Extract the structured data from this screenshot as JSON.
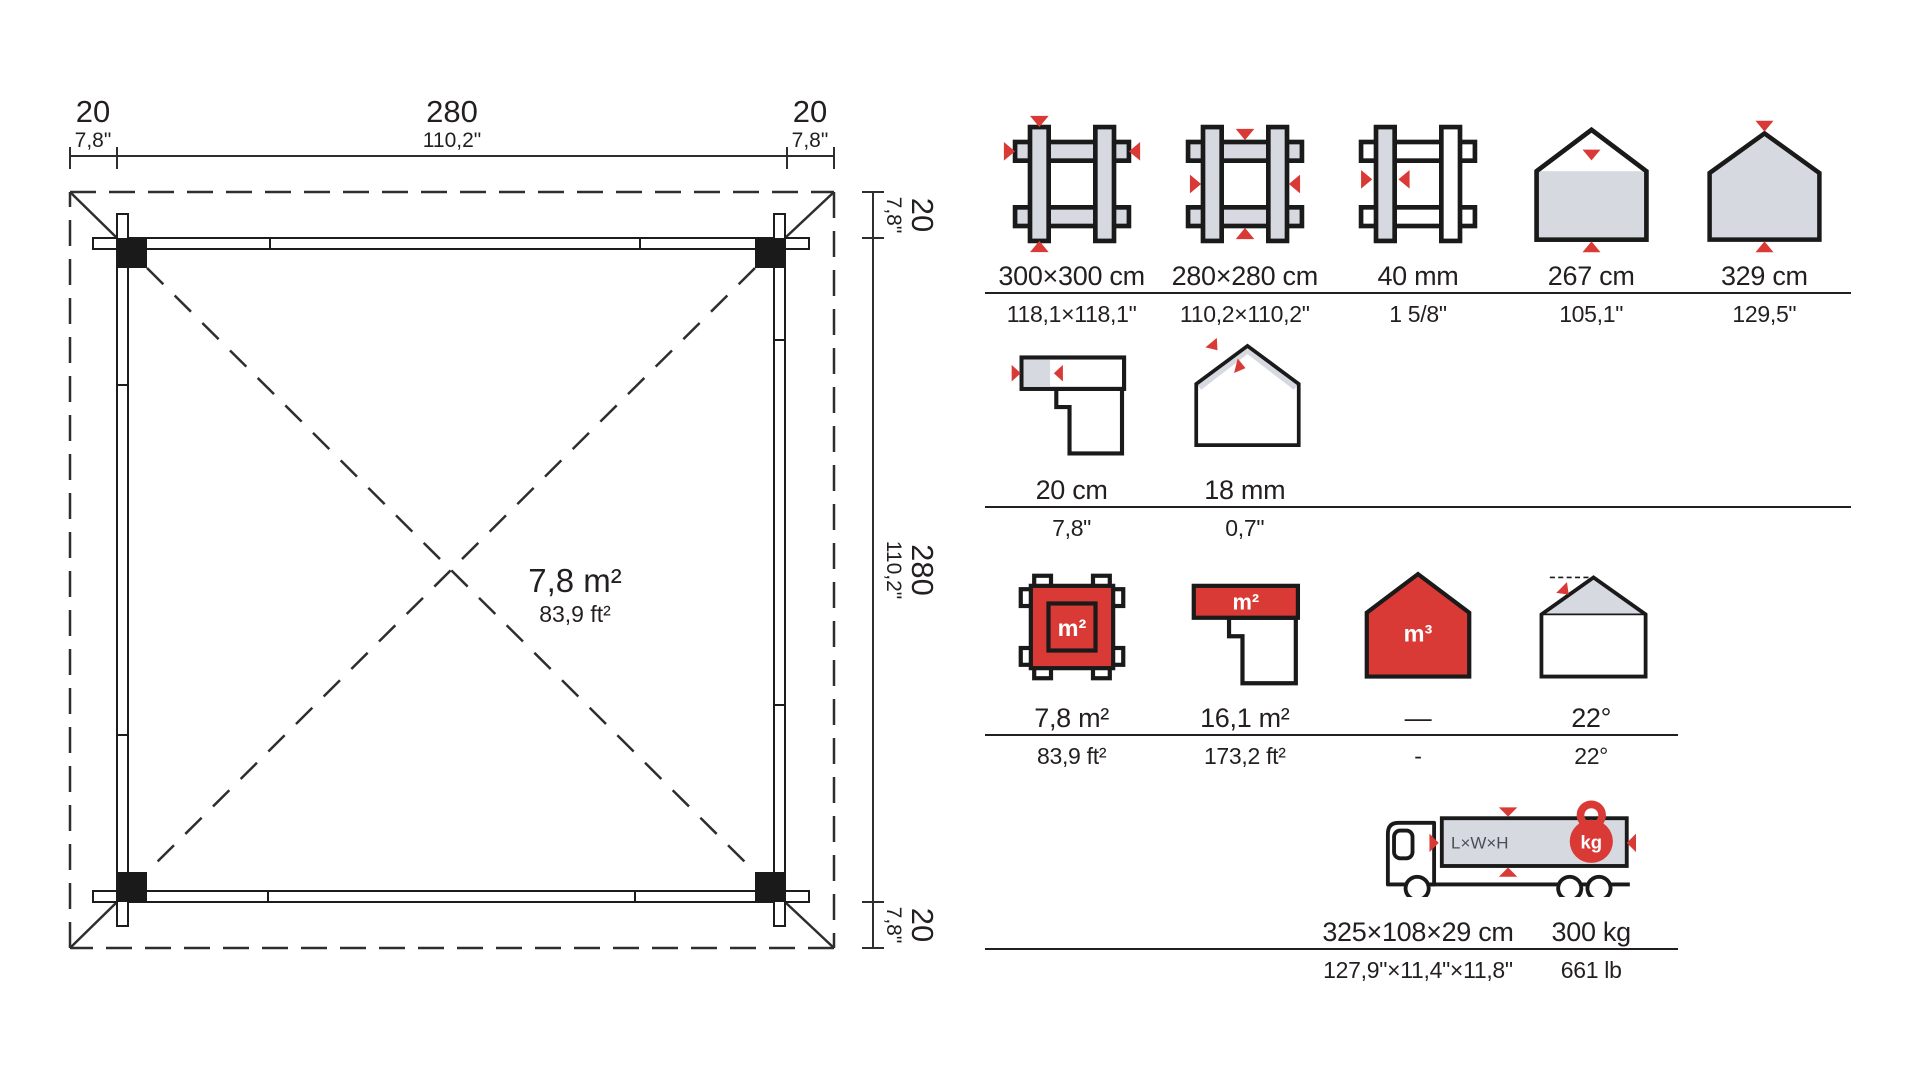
{
  "plan": {
    "area": {
      "metric": "7,8 m²",
      "imperial": "83,9 ft²"
    },
    "dim_top": {
      "left_cm": "20",
      "left_in": "7,8\"",
      "mid_cm": "280",
      "mid_in": "110,2\"",
      "right_cm": "20",
      "right_in": "7,8\""
    },
    "dim_right": {
      "top_cm": "20",
      "top_in": "7,8\"",
      "mid_cm": "280",
      "mid_in": "110,2\"",
      "bot_cm": "20",
      "bot_in": "7,8\""
    }
  },
  "specs": {
    "row1": [
      {
        "name": "outer-footprint",
        "metric": "300×300 cm",
        "imperial": "118,1×118,1\""
      },
      {
        "name": "inner-footprint",
        "metric": "280×280 cm",
        "imperial": "110,2×110,2\""
      },
      {
        "name": "wall-thickness",
        "metric": "40 mm",
        "imperial": "1 5/8\""
      },
      {
        "name": "wall-height",
        "metric": "267 cm",
        "imperial": "105,1\""
      },
      {
        "name": "ridge-height",
        "metric": "329 cm",
        "imperial": "129,5\""
      }
    ],
    "row2": [
      {
        "name": "roof-overhang",
        "metric": "20 cm",
        "imperial": "7,8\""
      },
      {
        "name": "roof-board-thickness",
        "metric": "18 mm",
        "imperial": "0,7\""
      }
    ],
    "row3": [
      {
        "name": "floor-area",
        "metric": "7,8 m²",
        "imperial": "83,9 ft²"
      },
      {
        "name": "roof-area",
        "metric": "16,1 m²",
        "imperial": "173,2 ft²"
      },
      {
        "name": "volume",
        "metric": "—",
        "imperial": "-"
      },
      {
        "name": "roof-pitch",
        "metric": "22°",
        "imperial": "22°"
      }
    ],
    "row4": [
      {
        "name": "package-dimensions",
        "metric": "325×108×29 cm",
        "imperial": "127,9\"×11,4\"×11,8\""
      },
      {
        "name": "weight",
        "metric": "300 kg",
        "imperial": "661 lb"
      }
    ],
    "icon_texts": {
      "m2": "m²",
      "m3": "m³",
      "lwh": "L×W×H",
      "kg": "kg"
    }
  },
  "colors": {
    "red": "#d93a35",
    "gray": "#d6d9e0",
    "ink": "#231f20"
  }
}
